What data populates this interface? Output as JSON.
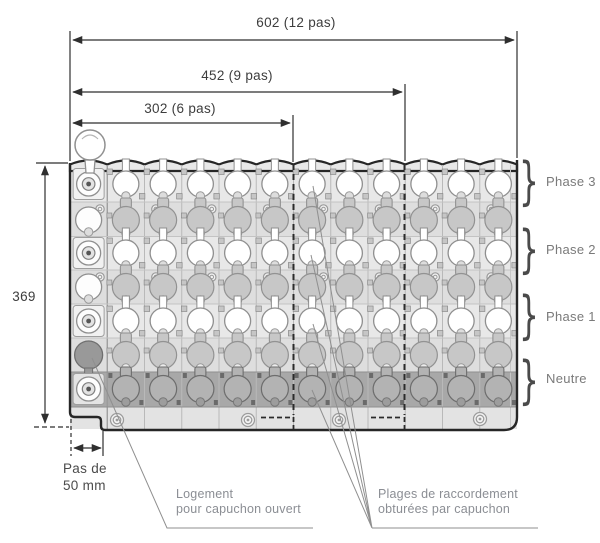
{
  "title": "Schéma coté d'un répartiteur tétrapolaire",
  "dimensions": {
    "width_total": "602 (12 pas)",
    "width_9pas": "452 (9 pas)",
    "width_6pas": "302 (6 pas)",
    "height": "369",
    "pitch_line1": "Pas de",
    "pitch_line2": "50 mm"
  },
  "row_labels": [
    "Phase 3",
    "Phase 2",
    "Phase 1",
    "Neutre"
  ],
  "callouts": {
    "open_cap_line1": "Logement",
    "open_cap_line2": "pour capuchon ouvert",
    "capped_line1": "Plages de raccordement",
    "capped_line2": "obturées par capuchon"
  },
  "icons": {
    "brace": "}"
  },
  "colors": {
    "outline": "#262626",
    "dim_line": "#2f2f2f",
    "leader": "#8f8f8f",
    "cell_line": "#b9b9b9",
    "band_open": "#e8e8e8",
    "band_capped": "#dedede",
    "band_neutral": "#a8a8a8",
    "strip": "#e3e3e3",
    "circle_open": "#ffffff",
    "circle_capped": "#c7c7c7",
    "circle_neutral": "#b3b3b3",
    "circle_dark_cap": "#999999",
    "circle_stroke": "#8f8f8f",
    "notch_open": "#dddddd",
    "notch_capped": "#ececec",
    "notch_neutral": "#9d9d9d"
  },
  "block": {
    "columns": 12,
    "x": 70,
    "right": 517,
    "top": 163,
    "bottom": 430,
    "neutral_bottom": 407,
    "rows": [
      {
        "kind": "open",
        "cy": 184
      },
      {
        "kind": "capped",
        "cy": 220
      },
      {
        "kind": "open",
        "cy": 253
      },
      {
        "kind": "capped",
        "cy": 287
      },
      {
        "kind": "open",
        "cy": 321
      },
      {
        "kind": "capped",
        "cy": 355
      },
      {
        "kind": "neutral",
        "cy": 389
      }
    ]
  }
}
